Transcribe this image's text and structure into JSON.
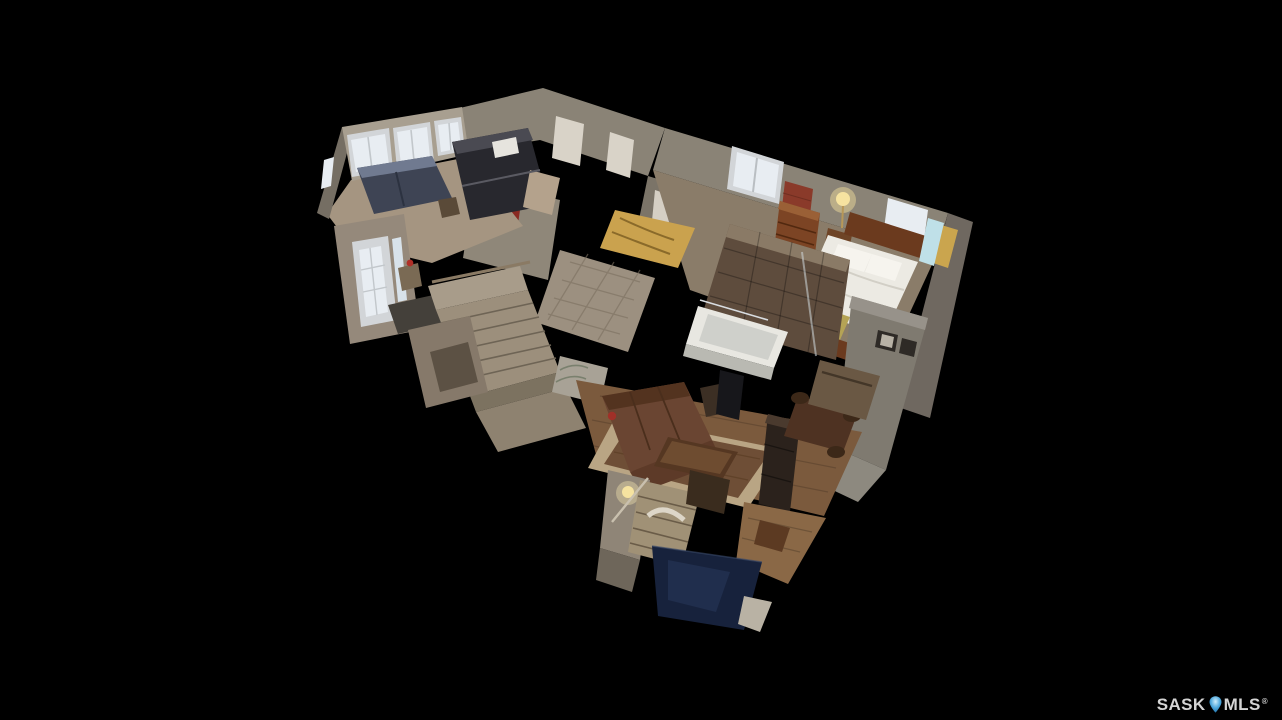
{
  "viewer": {
    "type": "3d-dollhouse-tour",
    "description": "Cutaway 3D dollhouse view of a bungalow interior floating on a black background",
    "rooms_visible": [
      "front bedroom with bay windows",
      "kitchen with dark appliances",
      "central hallway and closets",
      "master bedroom with bed, dresser and lamp",
      "bathroom with tiled wall and soaker tub",
      "entryway with glazed front door",
      "main staircase",
      "living room with sectional, rug, TV and fireplace column",
      "dining area",
      "basement stairwell with archway",
      "lower level area with navy floor"
    ]
  },
  "watermark": {
    "prefix": "SASK",
    "suffix": "MLS",
    "registered": "®",
    "text_color": "#d4d4d4",
    "pin_color": "#4fa8dc"
  },
  "palette": {
    "background": "#000000",
    "wall_light": "#a89f90",
    "wall_mid": "#8a8376",
    "wall_dark": "#6f6860",
    "wall_deep": "#756e63",
    "floor_tan": "#a59581",
    "wood_floor": "#7b5a3d",
    "window_glow": "#e8edf2",
    "window_frame": "#d2d5d8",
    "tile_brown": "#5e4c3d",
    "tub_white": "#e8e7e1",
    "duvet_white": "#eceae3",
    "headboard_wood": "#6b3a1e",
    "sofa_brown": "#6a4532",
    "rug_brown": "#6e4e36",
    "rug_border": "#b9a584",
    "navy_floor": "#17223c",
    "dresser_wood": "#7c4424",
    "brick_red": "#8a3a2a",
    "lamp_glow": "#f6e3a0",
    "appliance_dark": "#28282e",
    "gold_drape": "#caa24e",
    "fireplace_dark": "#2b221c",
    "stair_tan": "#9c8f7c",
    "couch_navy": "#3e4454"
  }
}
